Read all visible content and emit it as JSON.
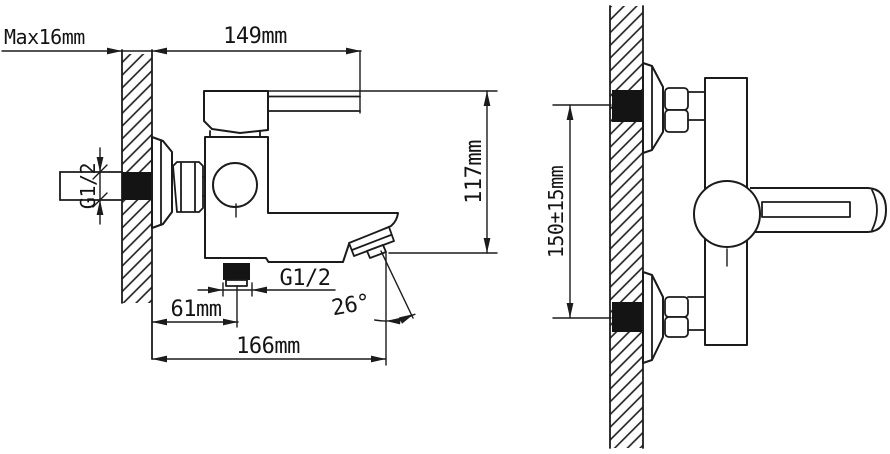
{
  "drawing": {
    "type": "technical-installation-drawing",
    "subject": "wall-mounted bath mixer faucet, side view and front view",
    "colors": {
      "background": "#ffffff",
      "line": "#1b1b1b",
      "solid_fill": "#141414"
    },
    "side_view": {
      "labels": {
        "wall_thickness": "Max16mm",
        "handle_reach": "149mm",
        "inlet_thread": "G1/2",
        "body_height": "117mm",
        "outlet_thread": "G1/2",
        "spout_center_offset": "61mm",
        "spout_angle": "26°",
        "total_reach": "166mm"
      }
    },
    "front_view": {
      "labels": {
        "inlet_spacing": "150±15mm"
      }
    }
  }
}
